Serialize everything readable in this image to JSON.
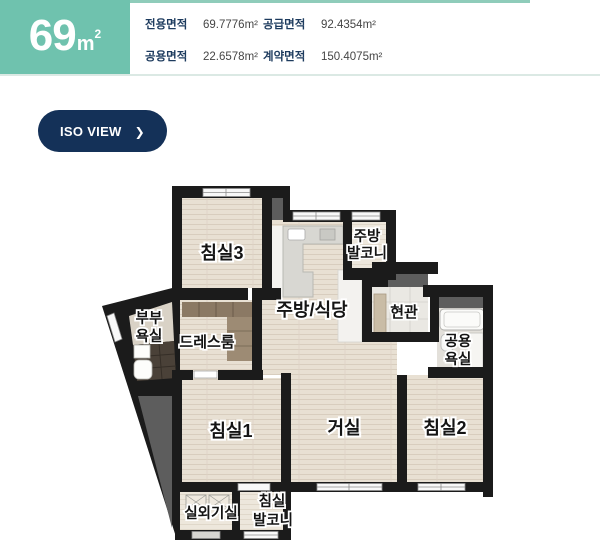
{
  "header": {
    "size_value": "69",
    "size_unit_base": "m",
    "size_unit_sup": "2",
    "areas": [
      {
        "label": "전용면적",
        "value": "69.7776m²"
      },
      {
        "label": "공급면적",
        "value": "92.4354m²"
      },
      {
        "label": "공용면적",
        "value": "22.6578m²"
      },
      {
        "label": "계약면적",
        "value": "150.4075m²"
      }
    ]
  },
  "iso_button": {
    "label": "ISO VIEW",
    "chevron": "❯"
  },
  "floorplan": {
    "room_labels": {
      "bedroom3": "침실3",
      "kitchen_balcony_line1": "주방",
      "kitchen_balcony_line2": "발코니",
      "kitchen_dining": "주방/식당",
      "entrance": "현관",
      "master_bath_line1": "부부",
      "master_bath_line2": "욕실",
      "dressroom": "드레스룸",
      "common_bath_line1": "공용",
      "common_bath_line2": "욕실",
      "bedroom1": "침실1",
      "living_room": "거실",
      "bedroom2": "침실2",
      "outdoor_unit": "실외기실",
      "bedroom_balcony_line1": "침실",
      "bedroom_balcony_line2": "발코니"
    },
    "colors": {
      "accent_teal": "#6fc2ae",
      "button_navy": "#143158",
      "label_navy": "#1d3b5e",
      "value_gray": "#454545",
      "divider": "#dbe9e4",
      "wall_black": "#1b1b1b",
      "floor_beige": "#e8e0d3",
      "void_gray": "#5d5d5d"
    }
  }
}
